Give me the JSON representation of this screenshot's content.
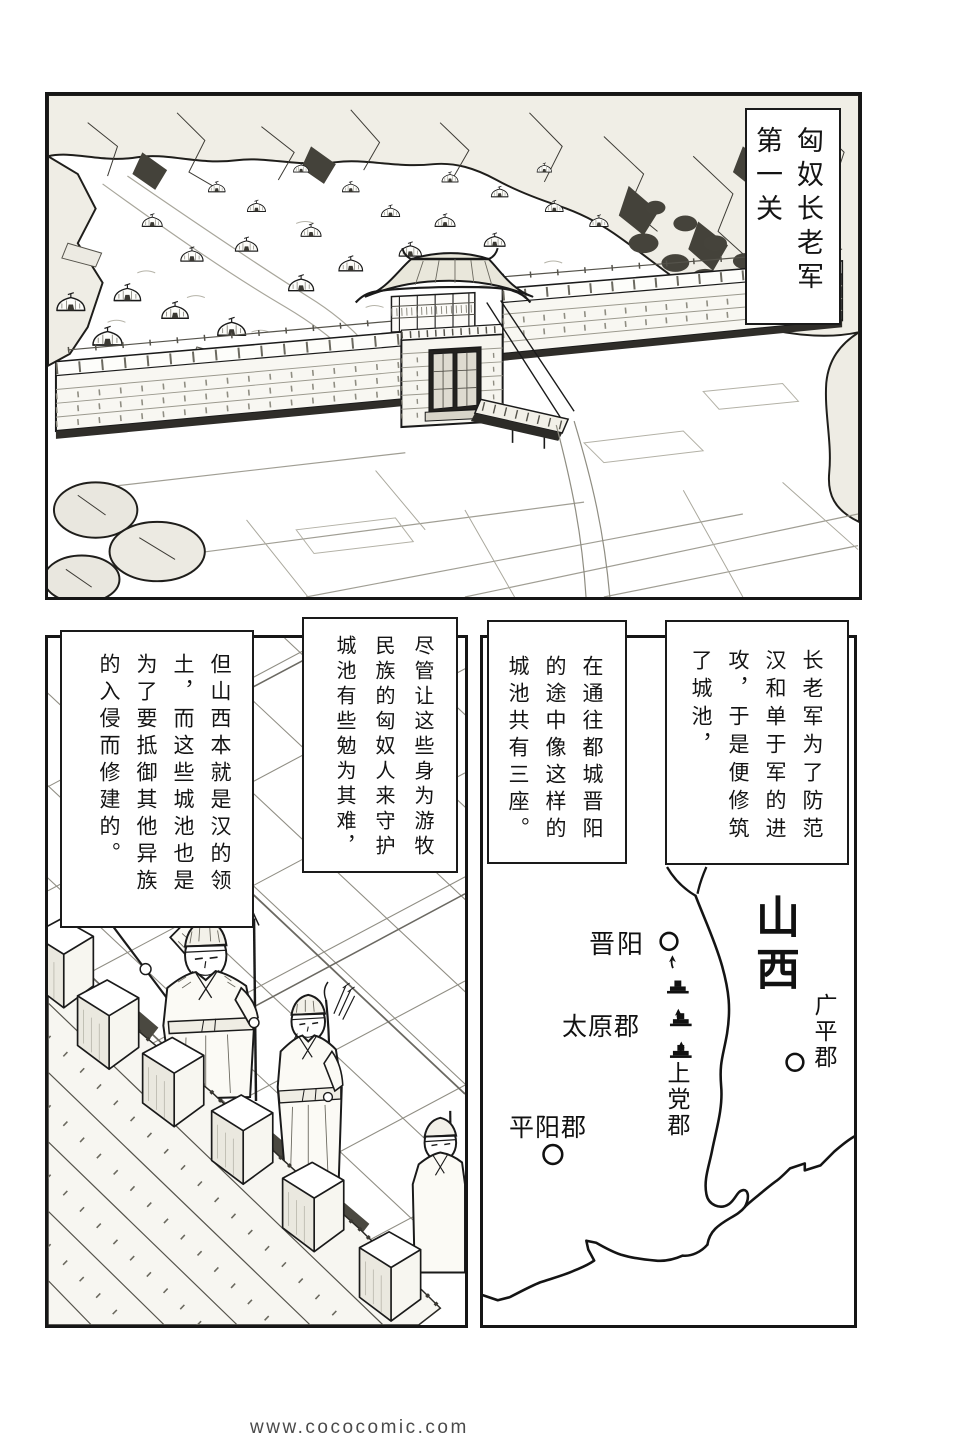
{
  "colors": {
    "ink": "#1a1a1a",
    "paper": "#ffffff",
    "watermark_gray": "#4a4a4a"
  },
  "footer": {
    "watermark": "www.cococomic.com"
  },
  "top_panel": {
    "caption_lines": [
      "匈奴长老军",
      "第一关"
    ]
  },
  "narration": {
    "box_a_lines": [
      "长老军为了防范",
      "汉和单于军的进",
      "攻，于是便修筑",
      "了城池，"
    ],
    "box_b_lines": [
      "在通往都城晋阳",
      "的途中像这样的",
      "城池共有三座。"
    ],
    "box_c_lines": [
      "尽管让这些身为游牧",
      "民族的匈奴人来守护",
      "城池有些勉为其难，"
    ],
    "box_d_lines": [
      "但山西本就是汉的领",
      "土，而这些城池也是",
      "为了要抵御其他异族",
      "的入侵而修建的。"
    ]
  },
  "map": {
    "region_label": "山西",
    "city_jinyang": "晋阳",
    "commandery_taiyuan": "太原郡",
    "commandery_shangdang": "上党郡",
    "commandery_pingyang": "平阳郡",
    "commandery_guangping": "广平郡",
    "fortress_icon_count": 3,
    "city_marker_count": 3
  }
}
